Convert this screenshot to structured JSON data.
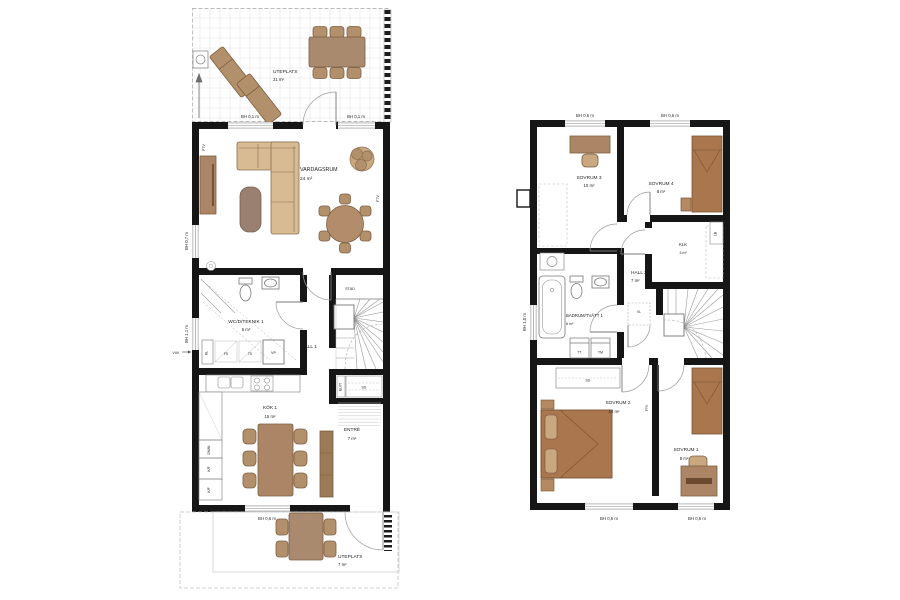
{
  "palette": {
    "wall": "#161616",
    "thin_line": "#8a8a8a",
    "grid_line": "#e2e2e2",
    "sofa": "#d8bb92",
    "furniture_mid": "#ab8565",
    "furniture_dark": "#9a8070",
    "bed": "#a9764e",
    "chair": "#b3906c",
    "chair_light": "#c9a87f",
    "table": "#a98a6e",
    "bench": "#9c7a55"
  },
  "floor1": {
    "patio_top": {
      "name": "UTEPLATS",
      "area": "21 m²"
    },
    "patio_bottom": {
      "name": "UTEPLATS",
      "area": "7 m²"
    },
    "window_labels": {
      "top_left": "BH 0,1 m",
      "top_right": "BH 0,1 m",
      "left_upper": "BH 0,7 m",
      "left_lower": "BH 1,1 m",
      "bottom": "BH 0,6 m"
    },
    "vuk": "VUK",
    "ftv_left": "FTV",
    "ftv_right": "FTV",
    "vardagsrum": {
      "name": "VARDAGSRUM",
      "area": "24 m²"
    },
    "wc": {
      "name": "WC/D/TEKNIK 1",
      "area": "6 m²",
      "kl": "KL",
      "fs": "FS",
      "ts": "TS",
      "vp": "VP"
    },
    "hall": {
      "name": "HALL 1"
    },
    "stad": "STÄD",
    "elit": "EL/IT",
    "sg": "SG",
    "kok": {
      "name": "KÖK 1",
      "area": "15 m²",
      "dmm": "DM/M",
      "kf1": "K/F",
      "kf2": "K/F"
    },
    "entre": {
      "name": "ENTRÉ",
      "area": "7 m²"
    }
  },
  "floor2": {
    "window_labels": {
      "top_left": "BH 0,6 m",
      "top_right": "BH 0,6 m",
      "left": "BH 1,0 m",
      "bottom_left": "BH 0,6 m",
      "bottom_right": "BH 0,6 m"
    },
    "sovrum3": {
      "name": "SOVRUM 3",
      "area": "10 m²"
    },
    "sovrum4": {
      "name": "SOVRUM 4",
      "area": "8 m²"
    },
    "klk": {
      "name": "KLK",
      "area": "3 m²"
    },
    "lb": "LB",
    "vl": "VL",
    "ftv": "FTV",
    "hall2": {
      "name": "HALL 2",
      "area": "7 m²"
    },
    "badrum": {
      "name": "BADRUM/TVÄTT 1",
      "area": "6 m²",
      "tt": "TT",
      "tm": "TM"
    },
    "sovrum2": {
      "name": "SOVRUM 2",
      "area": "14 m²",
      "sg": "SG"
    },
    "sovrum1": {
      "name": "SOVRUM 1",
      "area": "8 m²"
    }
  }
}
